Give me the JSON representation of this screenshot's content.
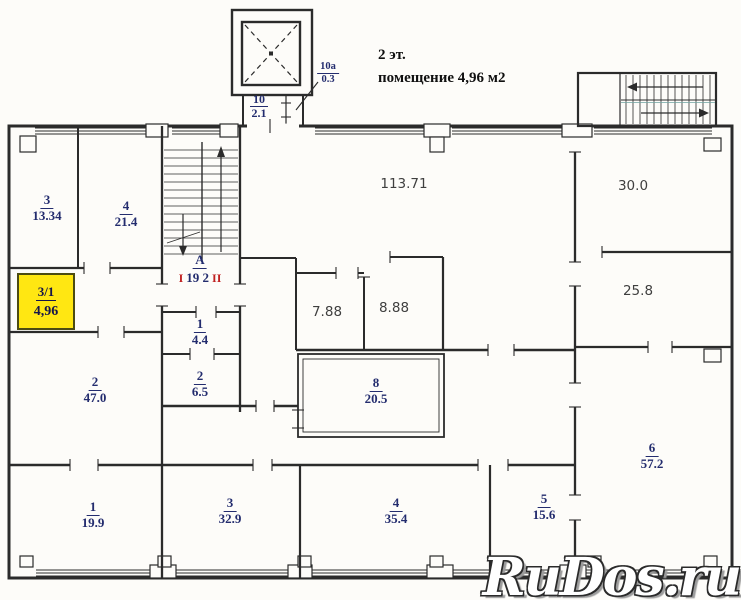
{
  "title": {
    "line1": "2 эт.",
    "line2": "помещение 4,96 м2"
  },
  "watermark": "RuDos.ru",
  "colors": {
    "highlight": "#ffe712",
    "wall": "#2b2b2b",
    "label_navy": "#232c6e",
    "label_gray": "#3f3f3f",
    "mark_red": "#c02020"
  },
  "highlight_room": {
    "number": "3/1",
    "area": "4,96"
  },
  "elevator": {
    "number": "10",
    "area": "2.1"
  },
  "elevator_annex": {
    "number": "10a",
    "area": "0.3"
  },
  "stairwell": {
    "letter": "А",
    "area": "19 2",
    "mark_left": "I",
    "mark_right": "II"
  },
  "rooms": [
    {
      "number": "3",
      "area": "13.34"
    },
    {
      "number": "4",
      "area": "21.4"
    },
    {
      "number": "1",
      "area": "4.4"
    },
    {
      "number": "2",
      "area": "6.5"
    },
    {
      "number": "8",
      "area": "20.5"
    },
    {
      "number": "2",
      "area": "47.0"
    },
    {
      "number": "1",
      "area": "19.9"
    },
    {
      "number": "3",
      "area": "32.9"
    },
    {
      "number": "4",
      "area": "35.4"
    },
    {
      "number": "5",
      "area": "15.6"
    },
    {
      "number": "6",
      "area": "57.2"
    }
  ],
  "open_areas": [
    {
      "area": "113.71"
    },
    {
      "area": "7.88"
    },
    {
      "area": "8.88"
    },
    {
      "area": "30.0"
    },
    {
      "area": "25.8"
    }
  ]
}
